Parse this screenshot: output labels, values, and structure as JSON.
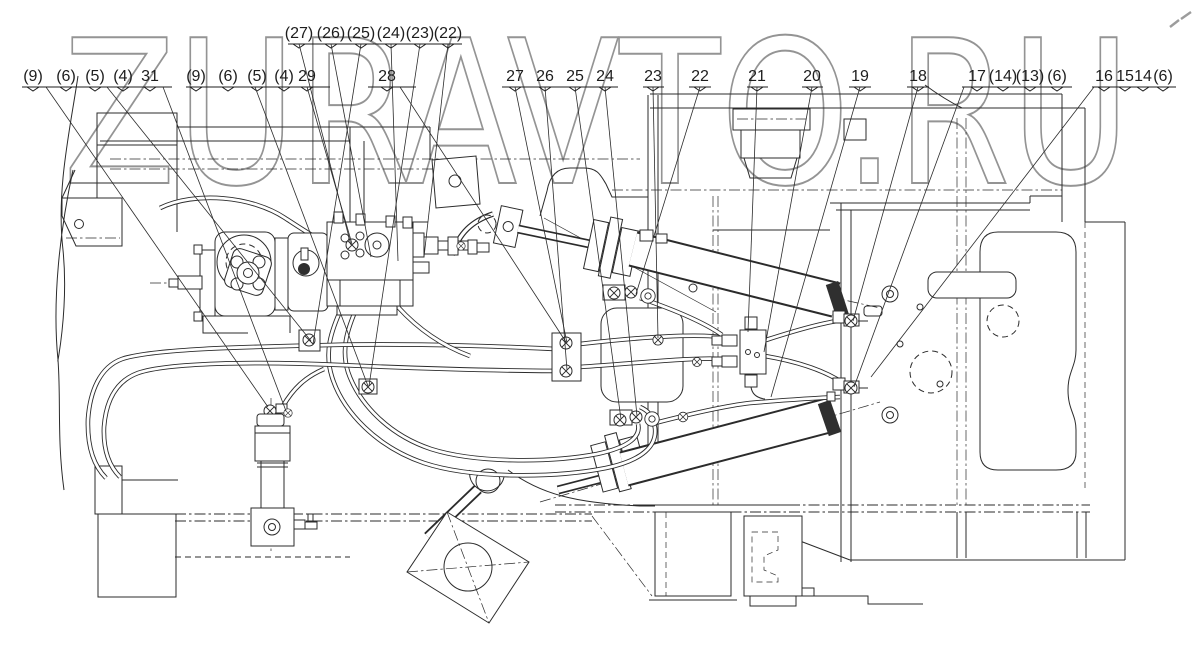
{
  "watermark": {
    "text": "ZURAVTO.RU",
    "color": "#949494"
  },
  "style": {
    "line_color": "#2b2b2b",
    "background": "#ffffff"
  },
  "callouts": {
    "groups": [
      {
        "id": "top-27-22",
        "label_y": 38,
        "bracket_y": 44,
        "bracket": [
          288,
          462
        ],
        "labels": [
          {
            "t": "(27)",
            "x": 299
          },
          {
            "t": "(26)",
            "x": 331
          },
          {
            "t": "(25)",
            "x": 361
          },
          {
            "t": "(24)",
            "x": 391
          },
          {
            "t": "(23)",
            "x": 420
          },
          {
            "t": "(22)",
            "x": 448
          }
        ],
        "leaders": [
          [
            299,
            44,
            351,
            245
          ],
          [
            331,
            44,
            371,
            257
          ],
          [
            361,
            44,
            313,
            344
          ],
          [
            391,
            44,
            398,
            261
          ],
          [
            420,
            44,
            369,
            386
          ],
          [
            448,
            44,
            424,
            257
          ]
        ]
      },
      {
        "id": "group-31",
        "label_y": 81,
        "bracket_y": 87,
        "bracket": [
          22,
          172
        ],
        "labels": [
          {
            "t": "(9)",
            "x": 33
          },
          {
            "t": "(6)",
            "x": 66
          },
          {
            "t": "(5)",
            "x": 95
          },
          {
            "t": "(4)",
            "x": 123
          },
          {
            "t": "31",
            "x": 150
          }
        ],
        "leaders": [
          [
            46,
            87,
            268,
            407
          ],
          [
            107,
            87,
            311,
            341
          ],
          [
            163,
            87,
            286,
            411
          ]
        ]
      },
      {
        "id": "group-29",
        "label_y": 81,
        "bracket_y": 87,
        "bracket": [
          186,
          330
        ],
        "labels": [
          {
            "t": "(9)",
            "x": 196
          },
          {
            "t": "(6)",
            "x": 228
          },
          {
            "t": "(5)",
            "x": 257
          },
          {
            "t": "(4)",
            "x": 284
          },
          {
            "t": "29",
            "x": 307
          }
        ],
        "leaders": [
          [
            255,
            87,
            368,
            386
          ],
          [
            307,
            87,
            352,
            244
          ]
        ]
      },
      {
        "id": "group-28",
        "label_y": 81,
        "bracket_y": 87,
        "bracket": [
          368,
          416
        ],
        "labels": [
          {
            "t": "28",
            "x": 387
          }
        ],
        "leaders": [
          [
            400,
            87,
            566,
            342
          ]
        ]
      },
      {
        "id": "group-27-24",
        "label_y": 81,
        "bracket_y": 87,
        "bracket": [
          502,
          618
        ],
        "labels": [
          {
            "t": "27",
            "x": 515
          },
          {
            "t": "26",
            "x": 545
          },
          {
            "t": "25",
            "x": 575
          },
          {
            "t": "24",
            "x": 605
          }
        ],
        "leaders": [
          [
            515,
            87,
            567,
            343
          ],
          [
            545,
            87,
            567,
            370
          ],
          [
            575,
            87,
            621,
            419
          ],
          [
            605,
            87,
            637,
            416
          ]
        ]
      },
      {
        "id": "group-23",
        "label_y": 81,
        "bracket_y": 87,
        "bracket": [
          643,
          664
        ],
        "labels": [
          {
            "t": "23",
            "x": 653
          }
        ],
        "leaders": [
          [
            653,
            87,
            658,
            338
          ]
        ]
      },
      {
        "id": "group-22",
        "label_y": 81,
        "bracket_y": 87,
        "bracket": [
          689,
          711
        ],
        "labels": [
          {
            "t": "22",
            "x": 700
          }
        ],
        "leaders": [
          [
            700,
            87,
            636,
            294
          ]
        ]
      },
      {
        "id": "group-21",
        "label_y": 81,
        "bracket_y": 87,
        "bracket": [
          747,
          768
        ],
        "labels": [
          {
            "t": "21",
            "x": 757
          }
        ],
        "leaders": [
          [
            757,
            87,
            748,
            332
          ]
        ]
      },
      {
        "id": "group-20",
        "label_y": 81,
        "bracket_y": 87,
        "bracket": [
          802,
          823
        ],
        "labels": [
          {
            "t": "20",
            "x": 812
          }
        ],
        "leaders": [
          [
            812,
            87,
            764,
            352
          ]
        ]
      },
      {
        "id": "group-19",
        "label_y": 81,
        "bracket_y": 87,
        "bracket": [
          849,
          871
        ],
        "labels": [
          {
            "t": "19",
            "x": 860
          }
        ],
        "leaders": [
          [
            860,
            87,
            771,
            397
          ]
        ]
      },
      {
        "id": "group-18",
        "label_y": 81,
        "bracket_y": 87,
        "bracket": [
          907,
          929
        ],
        "labels": [
          {
            "t": "18",
            "x": 918
          }
        ],
        "leaders": [
          [
            918,
            87,
            853,
            321
          ]
        ]
      },
      {
        "id": "group-17",
        "label_y": 81,
        "bracket_y": 87,
        "bracket": [
          962,
          1072
        ],
        "labels": [
          {
            "t": "17",
            "x": 977
          },
          {
            "t": "(14)",
            "x": 1003
          },
          {
            "t": "(13)",
            "x": 1030
          },
          {
            "t": "(6)",
            "x": 1057
          }
        ],
        "leaders": [
          [
            964,
            87,
            854,
            387
          ]
        ]
      },
      {
        "id": "group-16",
        "label_y": 81,
        "bracket_y": 87,
        "bracket": [
          1092,
          1176
        ],
        "labels": [
          {
            "t": "16",
            "x": 1104
          },
          {
            "t": "15",
            "x": 1125
          },
          {
            "t": "14",
            "x": 1143
          },
          {
            "t": "(6)",
            "x": 1163
          }
        ],
        "leaders": [
          [
            1094,
            87,
            871,
            377
          ]
        ]
      }
    ]
  }
}
